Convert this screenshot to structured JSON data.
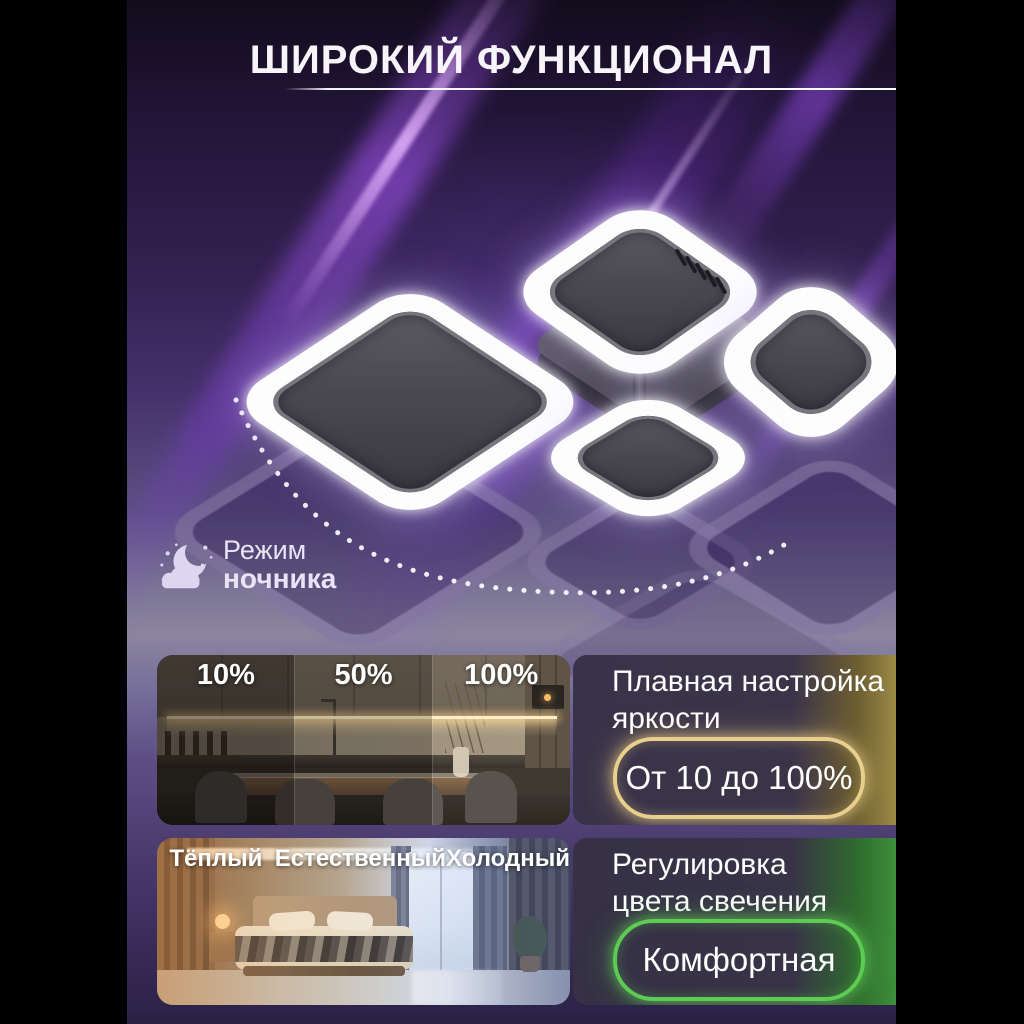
{
  "title": "ШИРОКИЙ ФУНКЦИОНАЛ",
  "night_mode": {
    "icon": "moon-cloud-icon",
    "line1": "Режим",
    "line2": "ночника"
  },
  "brightness": {
    "photo_labels": [
      "10%",
      "50%",
      "100%"
    ],
    "heading_line1": "Плавная настройка",
    "heading_line2": "яркости",
    "badge": "От 10 до 100%",
    "accent_color": "#e8cf8e"
  },
  "color_temp": {
    "photo_labels": [
      "Тёплый",
      "Естественный",
      "Холодный"
    ],
    "heading_line1": "Регулировка",
    "heading_line2": "цвета свечения",
    "badge": "Комфортная",
    "accent_color": "#5ecb54"
  },
  "theme": {
    "letterbox": "#000000",
    "background_purple": "#3a2558",
    "streak_purple": "#a858f8",
    "ring_white": "#ffffff",
    "lamp_body_gray": "#4a4951"
  }
}
